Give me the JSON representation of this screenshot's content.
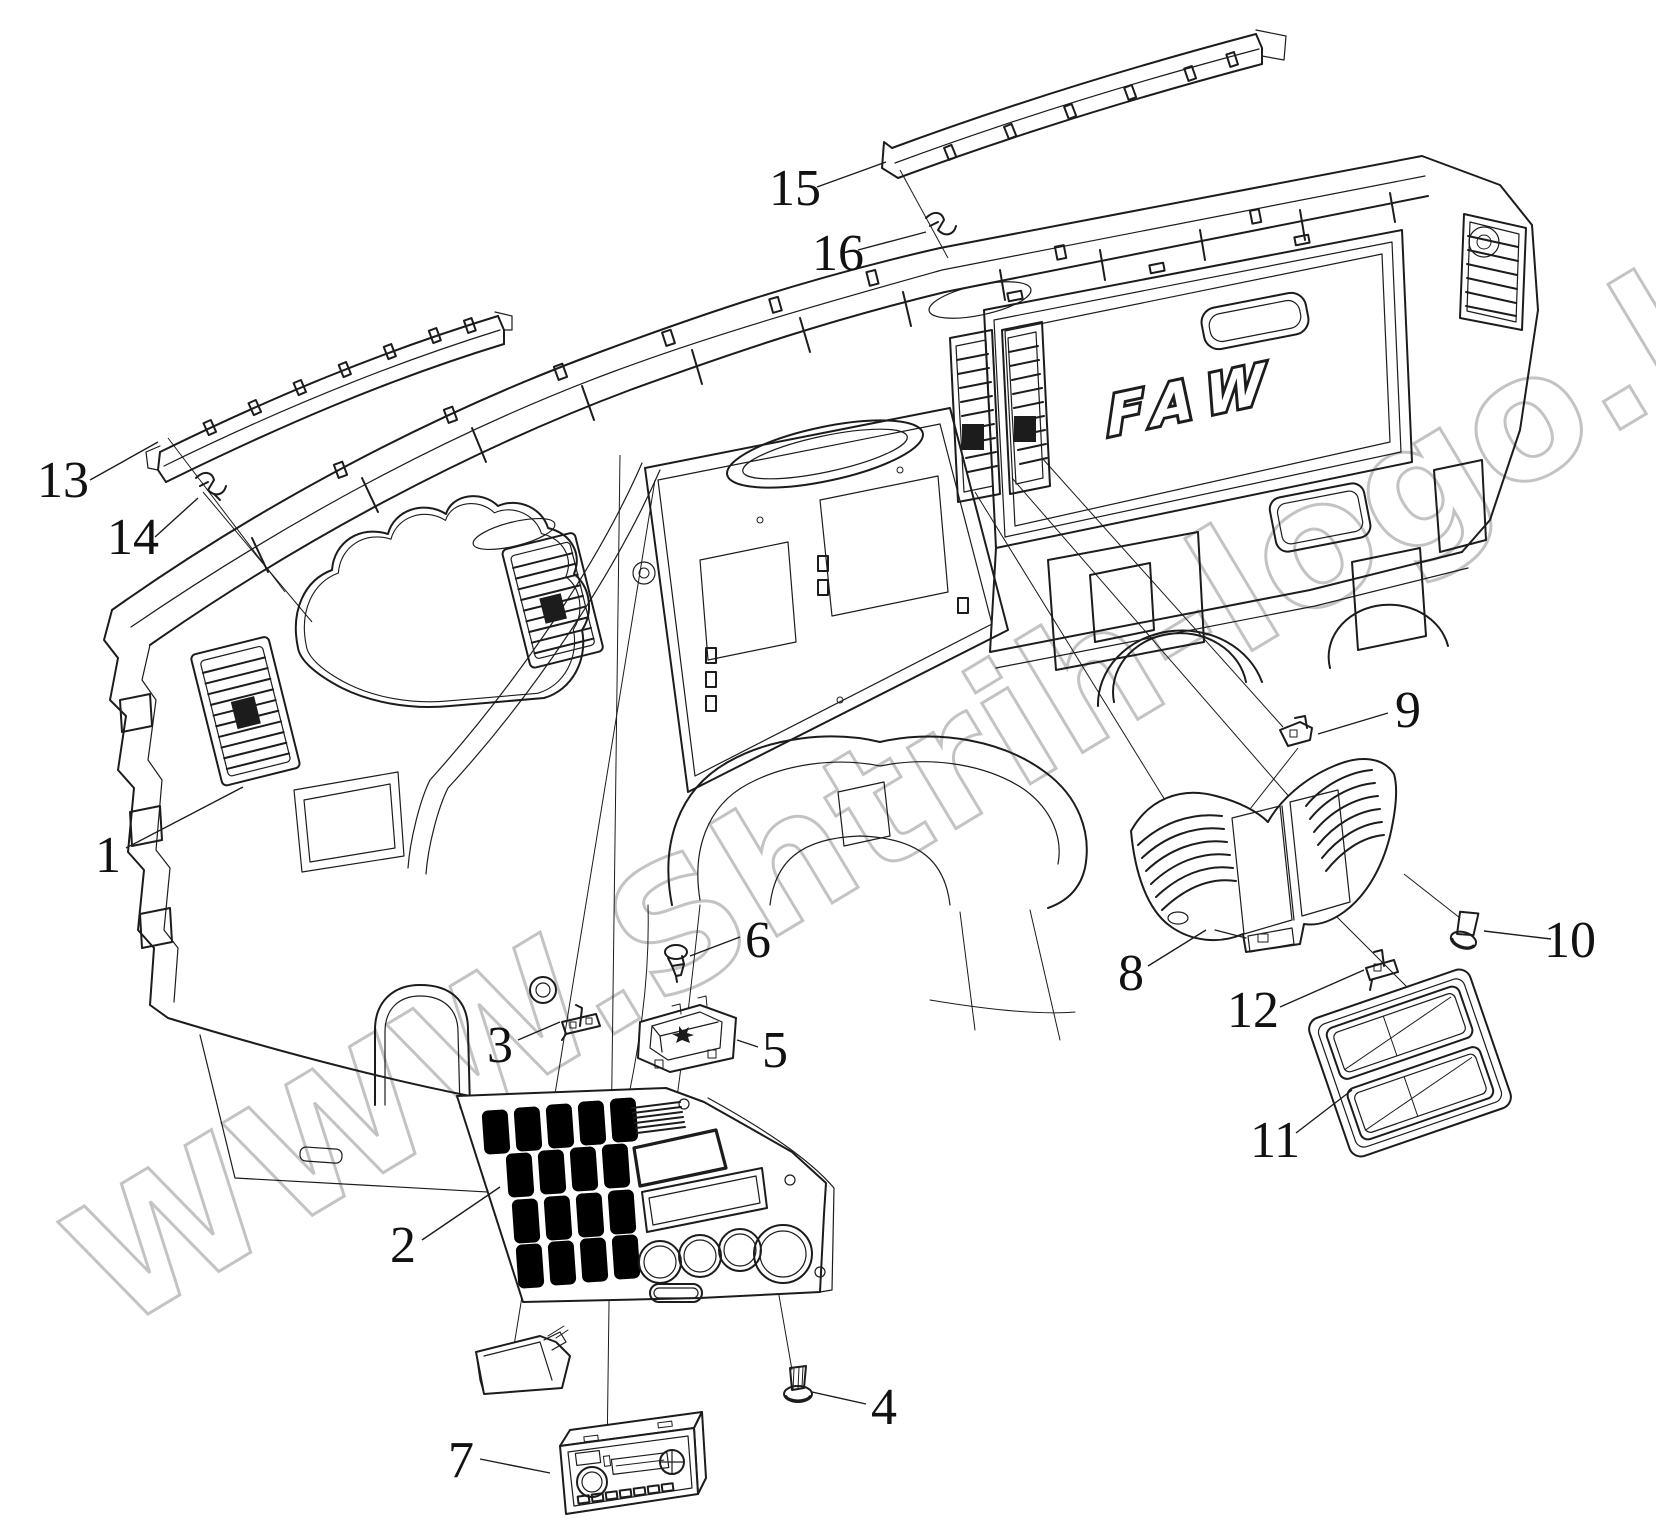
{
  "diagram": {
    "type": "exploded-parts-diagram",
    "subject": "truck instrument panel (dashboard) exploded view",
    "background": "#ffffff",
    "line_color": "#1c1c1c"
  },
  "brand_logo": {
    "text": "FAW"
  },
  "watermark": {
    "text": "WWW.Shtrih-logo.kz",
    "color": "#b9b9b9"
  },
  "callouts": [
    {
      "number": "1",
      "x": 108,
      "y": 860,
      "leader": [
        126,
        848,
        243,
        787
      ]
    },
    {
      "number": "2",
      "x": 403,
      "y": 1250,
      "leader": [
        422,
        1240,
        500,
        1187
      ]
    },
    {
      "number": "3",
      "x": 500,
      "y": 1050,
      "leader": [
        518,
        1040,
        560,
        1022
      ]
    },
    {
      "number": "4",
      "x": 884,
      "y": 1412,
      "leader": [
        866,
        1404,
        812,
        1392
      ]
    },
    {
      "number": "5",
      "x": 775,
      "y": 1055,
      "leader": [
        758,
        1047,
        737,
        1040
      ]
    },
    {
      "number": "6",
      "x": 758,
      "y": 945,
      "leader": [
        740,
        937,
        690,
        956
      ]
    },
    {
      "number": "7",
      "x": 461,
      "y": 1465,
      "leader": [
        480,
        1459,
        550,
        1473
      ]
    },
    {
      "number": "8",
      "x": 1131,
      "y": 978,
      "leader": [
        1148,
        966,
        1206,
        930
      ]
    },
    {
      "number": "9",
      "x": 1408,
      "y": 715,
      "leader": [
        1388,
        713,
        1318,
        734
      ]
    },
    {
      "number": "10",
      "x": 1570,
      "y": 945,
      "leader": [
        1551,
        939,
        1484,
        931
      ]
    },
    {
      "number": "11",
      "x": 1275,
      "y": 1145,
      "leader": [
        1296,
        1133,
        1352,
        1090
      ]
    },
    {
      "number": "12",
      "x": 1253,
      "y": 1015,
      "leader": [
        1280,
        1007,
        1364,
        970
      ]
    },
    {
      "number": "13",
      "x": 63,
      "y": 485,
      "leader": [
        90,
        480,
        158,
        442
      ]
    },
    {
      "number": "14",
      "x": 133,
      "y": 542,
      "leader": [
        155,
        537,
        198,
        498
      ]
    },
    {
      "number": "15",
      "x": 795,
      "y": 193,
      "leader": [
        817,
        187,
        886,
        162
      ]
    },
    {
      "number": "16",
      "x": 838,
      "y": 258,
      "leader": [
        858,
        250,
        926,
        232
      ]
    }
  ],
  "assembly_lines": [
    [
      168,
      438,
      285,
      592
    ],
    [
      203,
      492,
      312,
      622
    ],
    [
      900,
      170,
      948,
      258
    ],
    [
      620,
      455,
      607,
      1458
    ],
    [
      655,
      480,
      512,
      1358
    ],
    [
      762,
      1198,
      792,
      1370
    ],
    [
      975,
      492,
      1213,
      878
    ],
    [
      1012,
      478,
      1292,
      800
    ],
    [
      1322,
      902,
      1438,
      1018
    ],
    [
      1298,
      748,
      1188,
      888
    ],
    [
      1460,
      918,
      1404,
      874
    ],
    [
      1042,
      458,
      1283,
      727
    ]
  ]
}
